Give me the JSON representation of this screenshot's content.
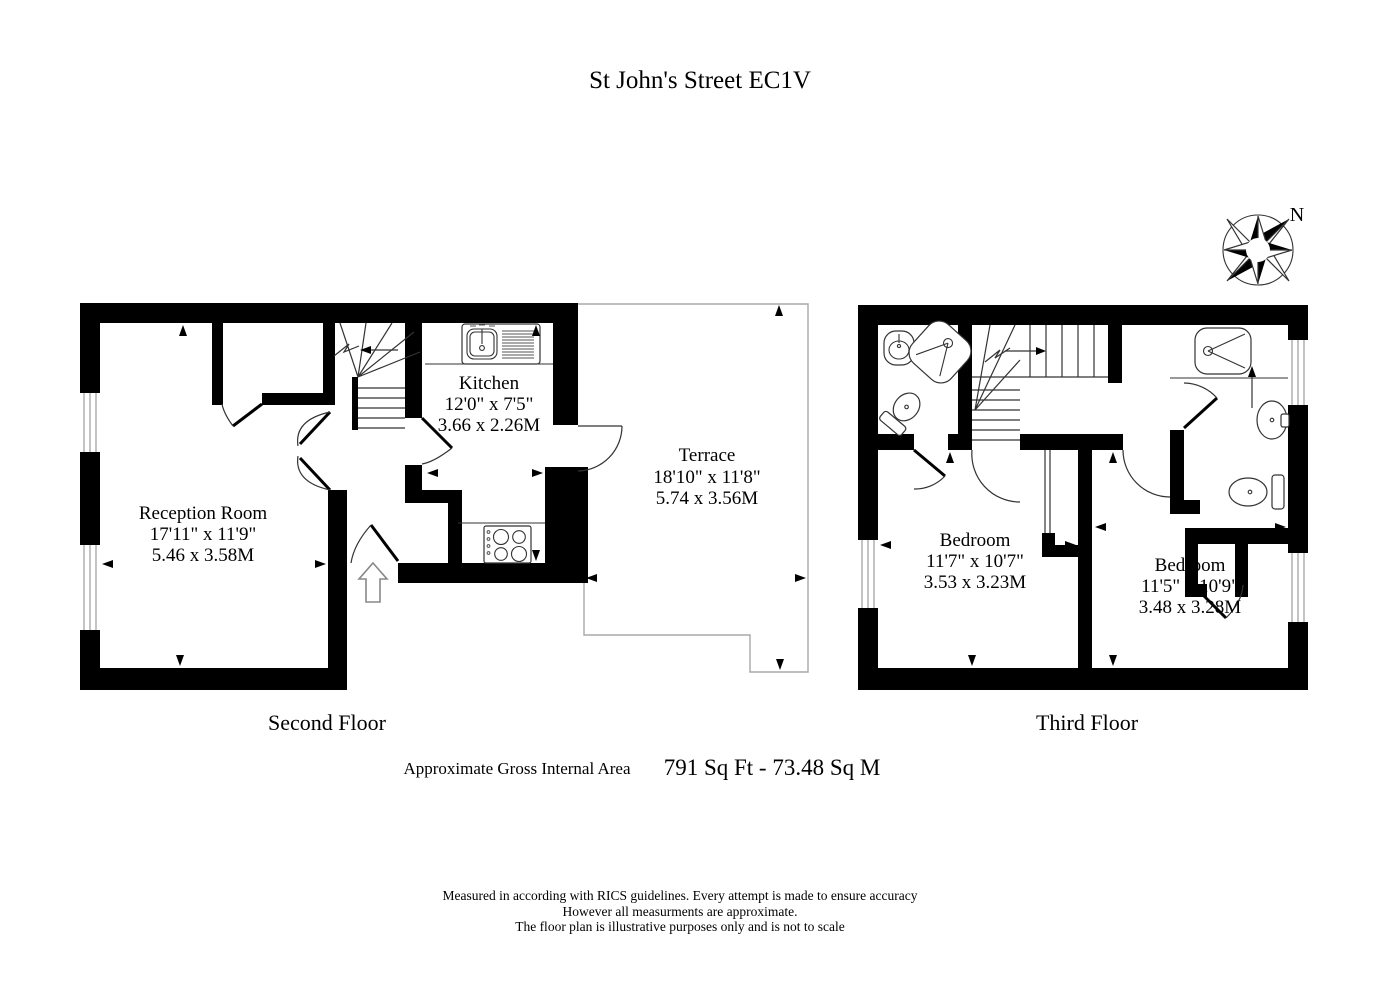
{
  "title": "St John's Street EC1V",
  "compass": {
    "north": "N"
  },
  "second_floor": {
    "label": "Second Floor",
    "reception": {
      "name": "Reception Room",
      "imperial": "17'11\" x 11'9\"",
      "metric": "5.46 x 3.58M"
    },
    "kitchen": {
      "name": "Kitchen",
      "imperial": "12'0\" x 7'5\"",
      "metric": "3.66 x 2.26M"
    },
    "terrace": {
      "name": "Terrace",
      "imperial": "18'10\" x 11'8\"",
      "metric": "5.74 x 3.56M"
    }
  },
  "third_floor": {
    "label": "Third Floor",
    "bedroom1": {
      "name": "Bedroom",
      "imperial": "11'7\" x 10'7\"",
      "metric": "3.53 x 3.23M"
    },
    "bedroom2": {
      "name": "Bedroom",
      "imperial": "11'5\" x 10'9\"",
      "metric": "3.48 x 3.28M"
    }
  },
  "area": {
    "label": "Approximate Gross Internal Area",
    "value": "791 Sq Ft - 73.48 Sq M"
  },
  "disclaimer": [
    "Measured in according with RICS guidelines. Every attempt is made to ensure accuracy",
    "However all measurments are approximate.",
    "The floor plan is illustrative purposes only and is not to scale"
  ],
  "colors": {
    "wall": "#000000",
    "line": "#333333",
    "terrace_outline": "#a8a8a8"
  }
}
